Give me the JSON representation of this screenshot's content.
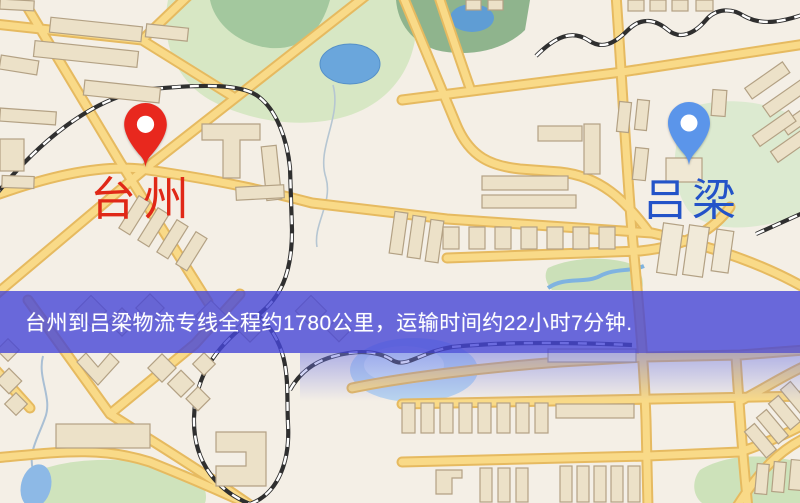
{
  "map": {
    "banner": {
      "text": "台州到吕梁物流专线全程约1780公里，运输时间约22小时7分钟.",
      "bg_color": "#4646d7",
      "text_color": "#ffffff"
    },
    "origin": {
      "label": "台州",
      "pin_color": "#e8281e",
      "label_color": "#e02817"
    },
    "destination": {
      "label": "吕梁",
      "pin_color": "#5b95ea",
      "label_color": "#2353c8"
    },
    "route": {
      "distance_km": "1780",
      "duration": "22小时7分钟"
    },
    "colors": {
      "background": "#f4efe6",
      "road_core": "#f9da88",
      "road_casing": "#e6ba60",
      "park": "#d7e7c4",
      "forest": "#8fb48d",
      "water": "#6aa6dc",
      "water_pale": "#b9d4ee",
      "building": "#ece1c8",
      "building_stroke": "#b3a184",
      "railway": "#2f2f2f"
    }
  }
}
